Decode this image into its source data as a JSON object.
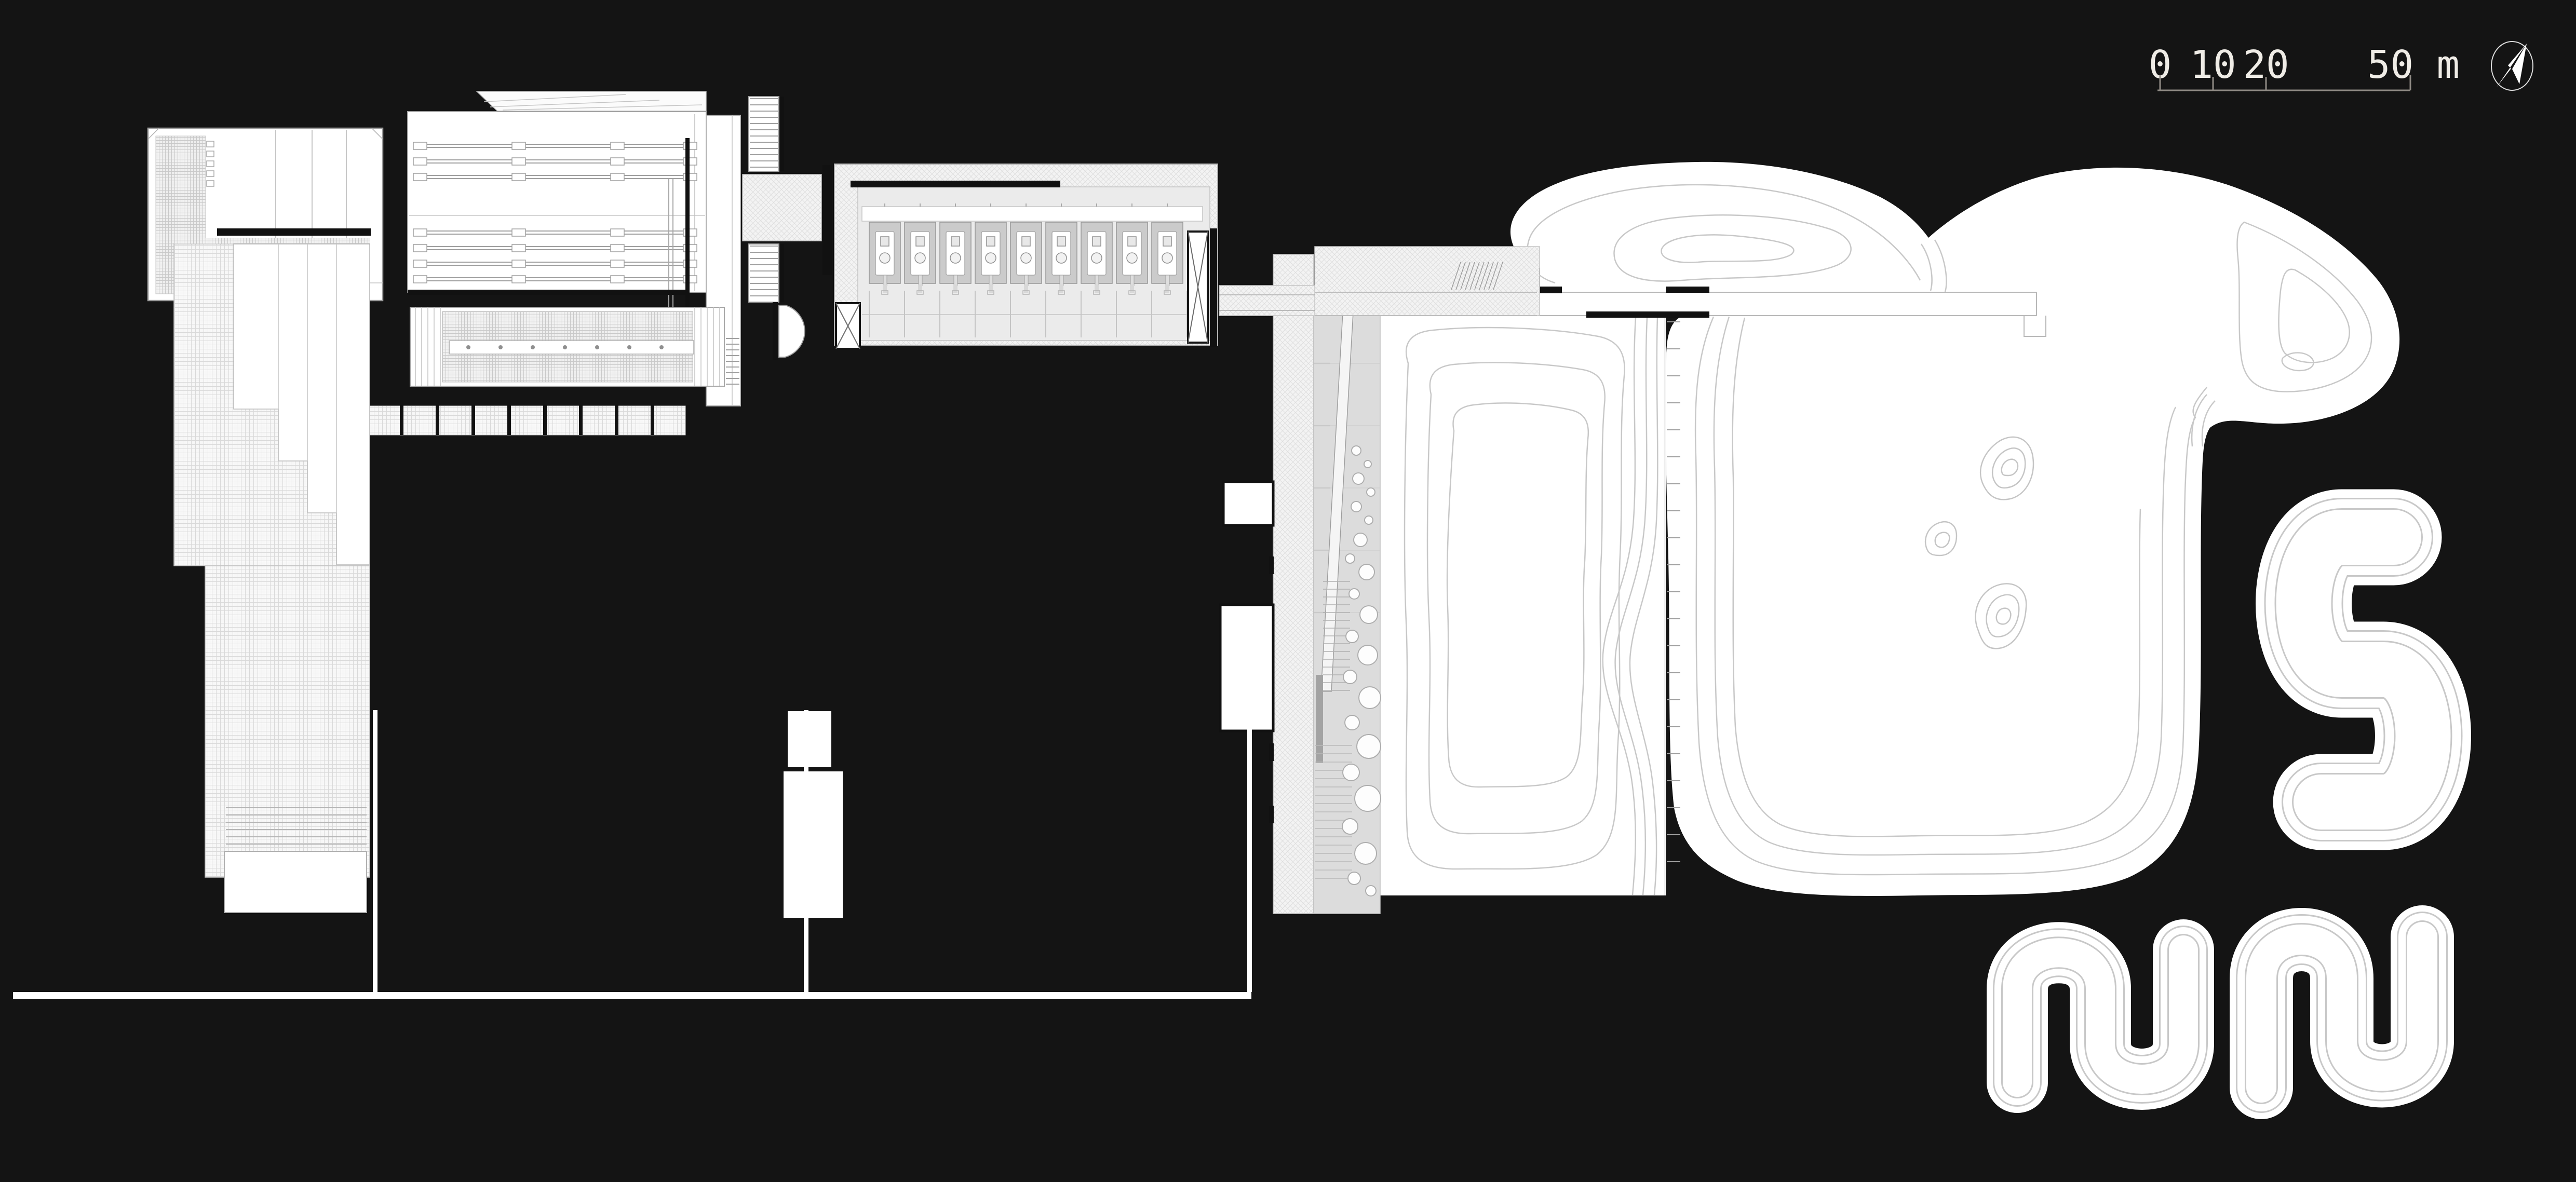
{
  "page": {
    "background": "#141414",
    "type_label": "architectural site plan"
  },
  "scale_bar": {
    "labels": [
      "0",
      "10",
      "20",
      "50 m"
    ],
    "values": [
      0,
      10,
      20,
      50
    ],
    "unit": "m"
  },
  "north_arrow": {
    "name": "north-arrow"
  },
  "plan": {
    "sanitary_cells": 9,
    "colonnade_posts": 9,
    "divider_ticks": 21,
    "contour_peaks": 3,
    "serpentine_landforms": 3,
    "areas": [
      "entry-building",
      "auditorium-hall",
      "trellis-courtyard",
      "colonnade-walk",
      "terraced-ramp-building",
      "stair-connectors",
      "sanitary-block",
      "access-plaza",
      "planted-ramp-strip",
      "contour-field-west",
      "contour-hill-east",
      "boardwalk",
      "serpentine-landforms",
      "service-paths"
    ],
    "colors": {
      "paper": "#ffffff",
      "line": "#a6a6a6",
      "contour": "#c8c8c8",
      "hatch": "#d8d8d8",
      "cell_fill": "#cbcbcb",
      "bed_fill": "#dcdcdc",
      "ink": "#141414"
    }
  }
}
